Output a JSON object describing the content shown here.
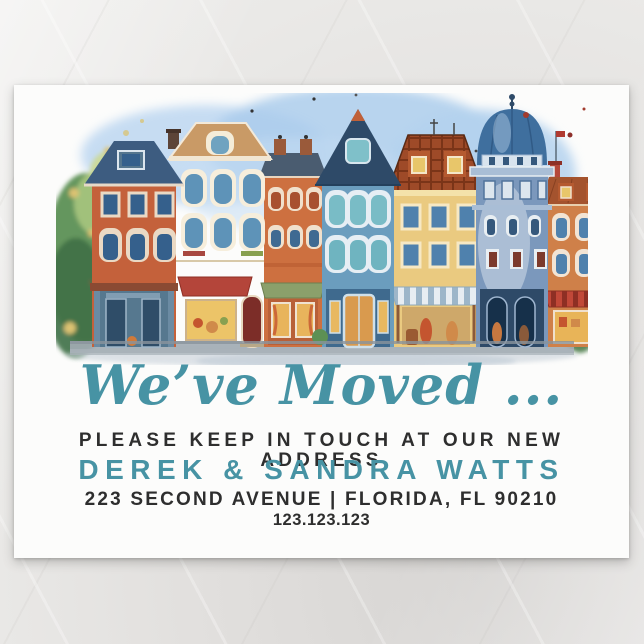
{
  "colors": {
    "accent_teal": "#4793a4",
    "body_text": "#2e2e2e",
    "card_white": "#fcfcfb",
    "background_gray": "#e8e6e4"
  },
  "card": {
    "headline": "We’ve Moved ...",
    "subline": "PLEASE KEEP IN TOUCH AT OUR NEW ADDRESS",
    "names": "DEREK & SANDRA WATTS",
    "address": "223 SECOND AVENUE | FLORIDA, FL 90210",
    "phone": "123.123.123"
  },
  "illustration": {
    "alt": "Watercolor row of colorful European townhouses with shops, a blue domed building and trees",
    "palette": [
      "#c4613b",
      "#eddcbd",
      "#cd7040",
      "#6b9dbe",
      "#eaca80",
      "#7b98bc",
      "#cf8049",
      "#3f6f9e",
      "#b4453a",
      "#5d9054",
      "#a2acb4",
      "#abccec"
    ]
  }
}
